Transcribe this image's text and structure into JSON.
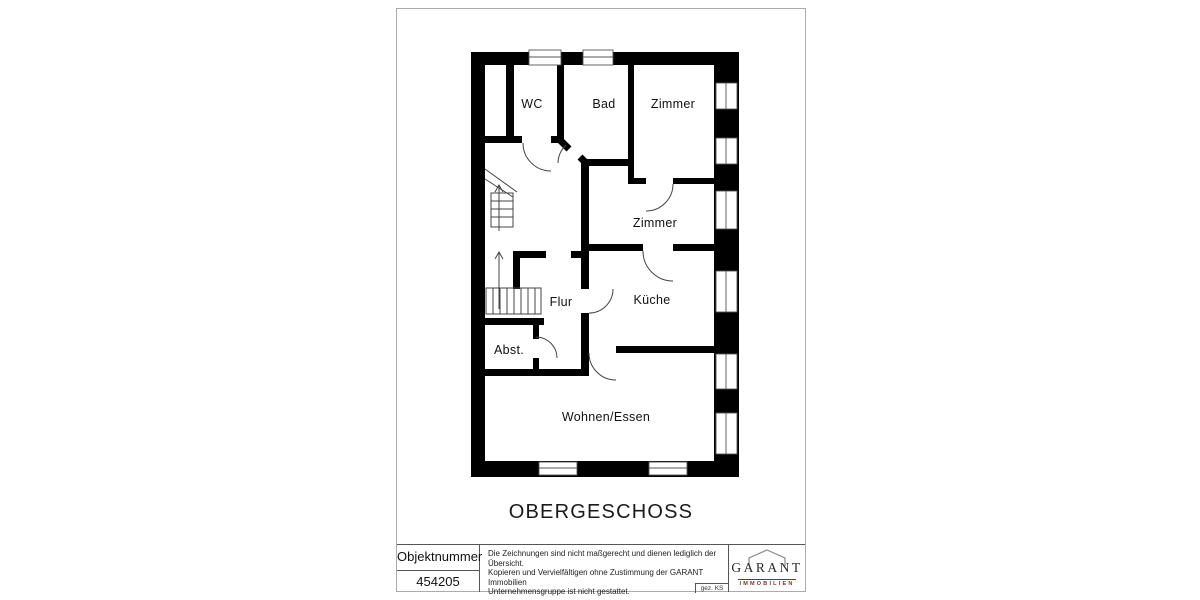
{
  "plan": {
    "title": "OBERGESCHOSS",
    "wall_color": "#000000",
    "rooms": [
      {
        "label": "WC"
      },
      {
        "label": "Bad"
      },
      {
        "label": "Zimmer"
      },
      {
        "label": "Zimmer"
      },
      {
        "label": "Flur"
      },
      {
        "label": "Küche"
      },
      {
        "label": "Abst."
      },
      {
        "label": "Wohnen/Essen"
      }
    ]
  },
  "title_block": {
    "object_number_label": "Objektnummer",
    "object_number_value": "454205",
    "disclaimer_lines": [
      "Die Zeichnungen sind nicht maßgerecht und dienen lediglich der Übersicht.",
      "Kopieren und Vervielfältigen ohne Zustimmung der GARANT Immobilien",
      "Unternehmensgruppe ist nicht gestattet."
    ],
    "signed": "gez. KS",
    "logo": {
      "name": "GARANT",
      "subtitle": "IMMOBILIEN",
      "accent_color": "#8b2a2a"
    }
  }
}
